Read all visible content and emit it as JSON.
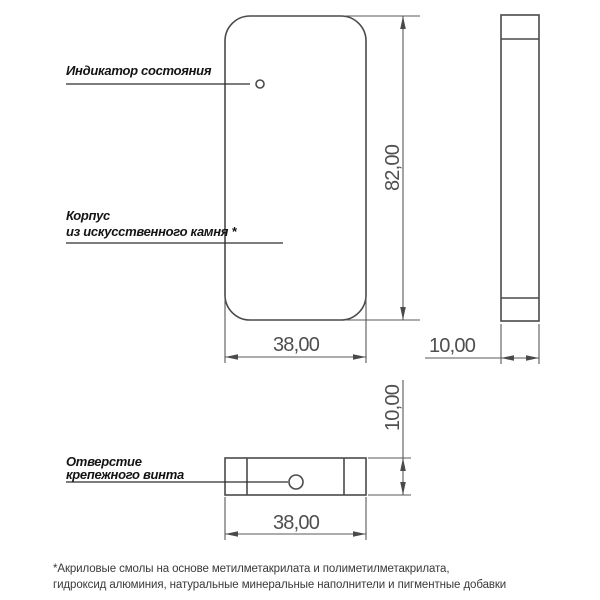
{
  "labels": {
    "indicator": {
      "line1": "Индикатор состояния"
    },
    "body": {
      "line1": "Корпус",
      "line2": "из искусственного камня *"
    },
    "hole": {
      "line1": "Отверстие",
      "line2": "крепежного винта"
    }
  },
  "dimensions": {
    "front_height": "82,00",
    "front_width": "38,00",
    "side_thickness": "10,00",
    "bottom_thickness": "10,00",
    "bottom_width": "38,00"
  },
  "footnote": {
    "line1": "*Акриловые смолы на основе метилметакрилата и полиметилметакрилата,",
    "line2": "гидроксид алюминия, натуральные минеральные наполнители и пигментные добавки"
  },
  "colors": {
    "background": "#ffffff",
    "geometry_line": "#4a4a4a",
    "dimension_line": "#585858",
    "label_text": "#141414",
    "dimension_text": "#4f4f4f",
    "footnote_text": "#3a3a3a"
  }
}
